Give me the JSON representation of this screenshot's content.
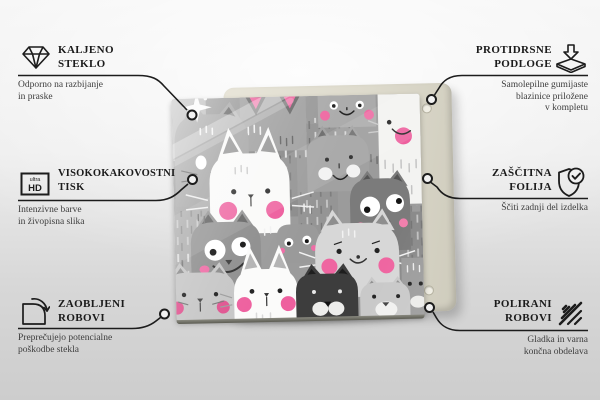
{
  "product": {
    "name": "glass board with cartoon cats pattern",
    "palette": {
      "background_top": "#f5f5f5",
      "background_bottom": "#cdcdcd",
      "line_color": "#1c1c1c",
      "title_color": "#1b1b1b",
      "subtitle_color": "#3d3d3d",
      "back_panel_cream": "#ddDAcc",
      "pattern_gray": "#9b9b9b",
      "pattern_dark": "#3d3d3d",
      "pattern_white": "#fafaf9",
      "accent_pink": "#ee5f9e"
    }
  },
  "icon_text": {
    "ultra": "ultra",
    "hd": "HD"
  },
  "callouts": {
    "tempered_glass": {
      "icon": "diamond-icon",
      "title_lines": [
        "KALJENO",
        "STEKLO"
      ],
      "subtitle_lines": [
        "Odporno na razbijanje",
        "in praske"
      ]
    },
    "anti_slip_pads": {
      "icon": "anti-slip-pad-icon",
      "title_lines": [
        "PROTIDRSNE",
        "PODLOGE"
      ],
      "subtitle_lines": [
        "Samolepilne gumijaste",
        "blazinice priložene",
        "v kompletu"
      ]
    },
    "high_quality_print": {
      "icon": "ultra-hd-icon",
      "title_lines": [
        "VISOKOKAKOVOSTNI",
        "TISK"
      ],
      "subtitle_lines": [
        "Intenzivne barve",
        "in živopisna slika"
      ]
    },
    "protective_film": {
      "icon": "shield-check-icon",
      "title_lines": [
        "ZAŠČITNA",
        "FOLIJA"
      ],
      "subtitle_lines": [
        "Ščiti zadnji del izdelka"
      ]
    },
    "rounded_edges": {
      "icon": "rounded-corner-icon",
      "title_lines": [
        "ZAOBLJENI",
        "ROBOVI"
      ],
      "subtitle_lines": [
        "Preprečujejo potencialne",
        "poškodbe stekla"
      ]
    },
    "polished_edges": {
      "icon": "polished-edge-icon",
      "title_lines": [
        "POLIRANI",
        "ROBOVI"
      ],
      "subtitle_lines": [
        "Gladka in varna",
        "končna obdelava"
      ]
    }
  }
}
